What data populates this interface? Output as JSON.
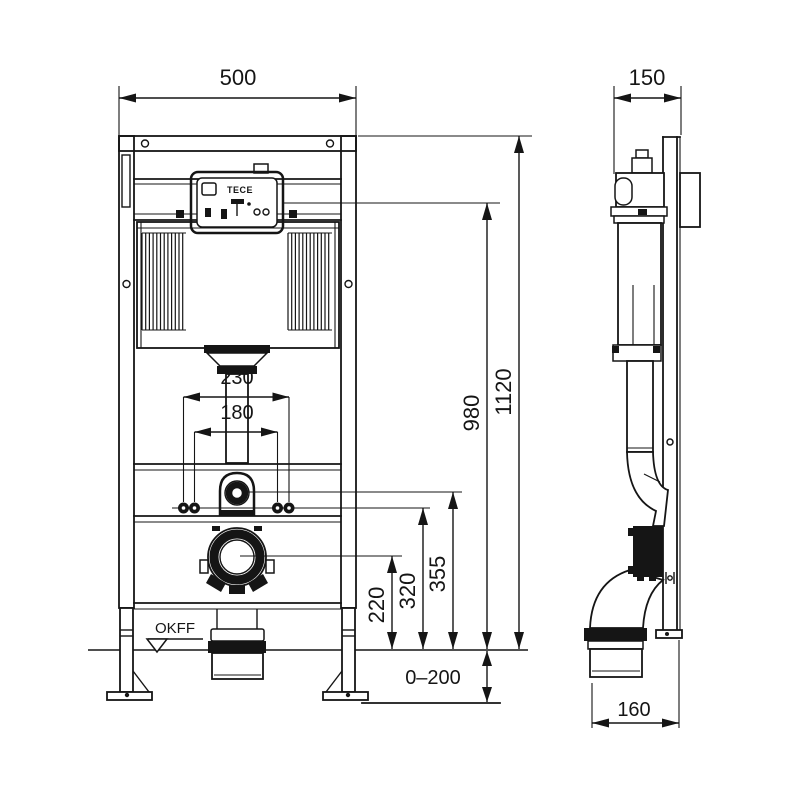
{
  "drawing": {
    "brand_label": "TECE",
    "floor_marker": "OKFF",
    "dimensions": {
      "frame_width": "500",
      "frame_depth": "150",
      "frame_height": "1120",
      "actuation_height": "980",
      "fixing_spread_outer": "230",
      "fixing_spread_inner": "180",
      "flush_bend_height": "355",
      "threaded_rod_height": "320",
      "outlet_height": "220",
      "leg_adjustment": "0–200",
      "outlet_offset": "160"
    }
  }
}
